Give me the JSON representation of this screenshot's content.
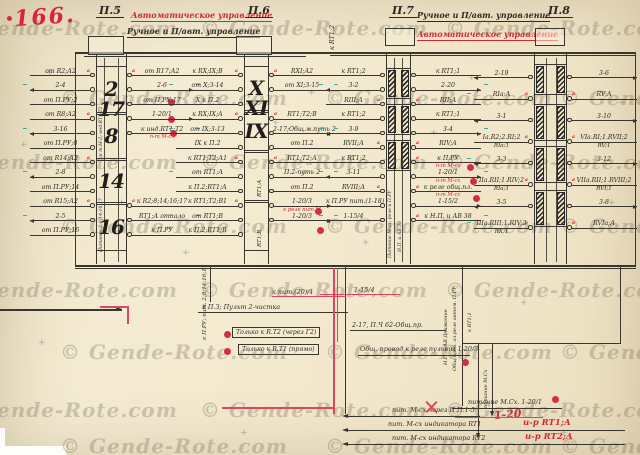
{
  "page": {
    "number": "166.",
    "watermark": "© Gende-Rote.com"
  },
  "captions": {
    "auto_left": "Автоматическое управление",
    "manual_left": "Ручное и П/авт. управление",
    "manual_right": "Ручное и П/авт. управление",
    "auto_right": "Автоматическое управление"
  },
  "panels": [
    {
      "title": "П.5",
      "blocks": [
        "2 17",
        "8",
        "14",
        "16"
      ],
      "rows": [
        {
          "l": "от R2;А2",
          "r": "от R17;А2",
          "la": true,
          "ra": true
        },
        {
          "l": "2-4",
          "r": "2-6"
        },
        {
          "l": "от П.РУ;2",
          "r": "от П.РУ;17"
        },
        {
          "l": "от R8;А2",
          "r": "1-20/1",
          "la": true,
          "rc": true
        },
        {
          "l": "3-16",
          "r": "к инд.RT1;Т2",
          "rn": "п-т М-сх"
        },
        {
          "l": "от П.РУ;8",
          "r": ""
        },
        {
          "l": "от R14;А2",
          "r": "",
          "la": true
        },
        {
          "l": "2-8",
          "r": ""
        },
        {
          "l": "от П.РУ;14",
          "r": ""
        },
        {
          "l": "от R15;А2",
          "r": "к R2;8;14;16;17",
          "la": true,
          "ra": true
        },
        {
          "l": "2-5",
          "r": "RT1;А отпало"
        },
        {
          "l": "от П.РУ;16",
          "r": "к П.РУ"
        }
      ]
    },
    {
      "title": "П.6",
      "blocks": [
        "Х ХI",
        "IХ",
        "RT1;А",
        "RT1;В"
      ],
      "rows": [
        {
          "l": "к RХ;IХ;В",
          "r": "RХI;А2",
          "la": true,
          "ra": true
        },
        {
          "l": "от Х;3-14",
          "r": "от ХI;3-15"
        },
        {
          "l": "Х к П.2",
          "r": ""
        },
        {
          "l": "к RХ;IХ;А",
          "r": "RT1;Т2;В",
          "la": true,
          "ra": true
        },
        {
          "l": "от IХ;3-13",
          "r": "2-17;Общ.м.путь 2"
        },
        {
          "l": "IХ к П.2",
          "r": "от П.2"
        },
        {
          "l": "к RT1;Т2;А1",
          "r": "RT1;Т2;А",
          "la": true,
          "ra": true
        },
        {
          "l": "от RT1;А",
          "r": "П.2-путь 2"
        },
        {
          "l": "к П.2;RT1;А",
          "r": "от П.2"
        },
        {
          "l": "к RT1;Т2;В1",
          "r": "1-20/3",
          "la": true,
          "rc": true,
          "rn": "к реле пит.М"
        },
        {
          "l": "от RT1;В",
          "r": "1-20/3"
        },
        {
          "l": "к П.2;RT1;В",
          "r": ""
        }
      ]
    },
    {
      "title": "П.7",
      "blocks": [
        "",
        "",
        ""
      ],
      "rows": [
        {
          "l": "к RT1;2",
          "r": "к RT1;1"
        },
        {
          "l": "3-2",
          "r": "2-20"
        },
        {
          "l": "RIII;А",
          "r": "RII;А",
          "la": true,
          "ra": true
        },
        {
          "l": "к RT1;2",
          "r": "к RT1;1"
        },
        {
          "l": "3-9",
          "r": "3-4"
        },
        {
          "l": "RVII;А",
          "r": "RIV;А",
          "la": true,
          "ra": true
        },
        {
          "l": "к RT1;2",
          "r": "к П.РУ",
          "rn": "п-т М-сх",
          "ra": true
        },
        {
          "l": "3-11",
          "r": "1-20/1",
          "rn": "п-т М-сх",
          "rc": true
        },
        {
          "l": "RVIII;А",
          "r": "к реле общ.пл.",
          "la": true,
          "rn": "п-т М-сх",
          "ra": true
        },
        {
          "l": "к П.РУ пит.(1-18)",
          "r": "1-15/2"
        },
        {
          "l": "1-15/4",
          "r": "к Н.П. и АВ 38",
          "ra": true
        },
        {
          "l": "",
          "r": ""
        }
      ]
    },
    {
      "title": "П.8",
      "blocks": [
        "",
        "",
        "",
        ""
      ],
      "rows": [
        {
          "l": "2-19",
          "r": "3-6"
        },
        {
          "l": "RIа;А",
          "r": "RV;А",
          "la": true,
          "ra": true
        },
        {
          "l": "3-1",
          "r": "3-10"
        },
        {
          "l": "Iа.R2;2.RI;2",
          "ls": "RIа;1",
          "r": "VIа.RI;1.RVII;2",
          "rs": "RV;1",
          "la": true,
          "ra": true
        },
        {
          "l": "3-3",
          "r": "3-12"
        },
        {
          "l": "IIа.RII;1.RIV;2",
          "ls": "RIа;1",
          "r": "VIIа.RII;1.RVIII;2",
          "rs": "RVI;1",
          "la": true,
          "ra": true
        },
        {
          "l": "3-5",
          "r": "3-8"
        },
        {
          "l": "IIIа.RIII;1.RIV;2",
          "ls": "RХ;1",
          "r": "RVIа;А",
          "la": true,
          "ra": true
        }
      ]
    }
  ],
  "annotations": {
    "v_pru": "к П.РУ; пит. 2;8;14;16;17",
    "t1": "к пит.(20)/1",
    "t2": "к П.З; Пульт 2-чистка",
    "t3": "1-15/4",
    "t4": "2-17, П.Ч 62-Общ.пр.",
    "box1": "Только к R.Т2 (через Г2)",
    "box2": "Только к R.Т1 (прямо)",
    "t5": "Общ. провод к реле пульты 1-20/3",
    "vr1": "Н.П. и АВ Движение",
    "vr2": "Общ.пров. эл.реле автом. П.РУ",
    "vr3": "к RT1;1",
    "vr4": "питание М.Сх",
    "vtop": "к RT1;2",
    "vp5a": "к т.М-2; инд.RT1;Т2",
    "vp5b": "Питание 2;8;14;16;17",
    "vp7a": "Питание М-сх; реле и П.РУ",
    "vp7b": "Н.П. и АВ 38"
  },
  "footer": {
    "l1": "пит. М-сх через П.П.1-5",
    "l2": "пит. М-сх индикатора RT1",
    "l2_red": "и-р RT1;А",
    "l3": "пит. М-сх индикатора RT2",
    "l3_red": "и-р RT2;А",
    "r1": "питание М.Сх. 1-20/1",
    "r1_red": "1-20"
  }
}
